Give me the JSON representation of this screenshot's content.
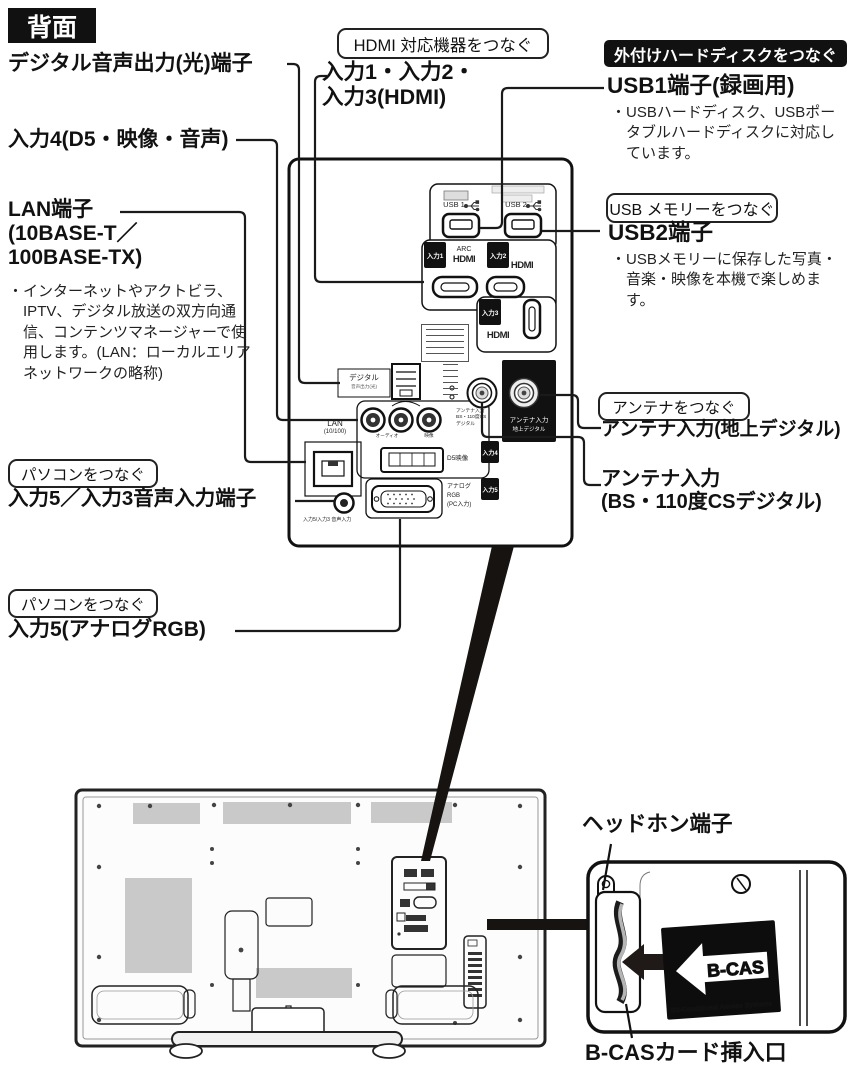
{
  "page": {
    "badge": "背面"
  },
  "left": {
    "optical": "デジタル音声出力(光)端子",
    "input4": "入力4(D5・映像・音声)",
    "lan1": "LAN端子",
    "lan2": "(10BASE-T／",
    "lan3": "100BASE-TX)",
    "bullet": "・",
    "lan_note": "インターネットやアクトビラ、IPTV、デジタル放送の双方向通信、コンテンツマネージャーで使用します。(LAN：ローカルエリアネットワークの略称)",
    "pc_tag": "パソコンをつなぐ",
    "input5_audio": "入力5／入力3音声入力端子",
    "input5_rgb": "入力5(アナログRGB)"
  },
  "top": {
    "hdmi_tag": "HDMI 対応機器をつなぐ",
    "hdmi_line1": "入力1・入力2・",
    "hdmi_line2": "入力3(HDMI)"
  },
  "right": {
    "hdd_tag": "外付けハードディスクをつなぐ",
    "usb1_title": "USB1端子(録画用)",
    "usb1_note": "USBハードディスク、USBポータブルハードディスクに対応しています。",
    "usb_tag": "USB メモリーをつなぐ",
    "usb2_title": "USB2端子",
    "usb2_note": "USBメモリーに保存した写真・音楽・映像を本機で楽しめます。",
    "ant_tag": "アンテナをつなぐ",
    "ant_terrestrial": "アンテナ入力(地上デジタル)",
    "ant_bs1": "アンテナ入力",
    "ant_bs2": "(BS・110度CSデジタル)"
  },
  "bottom": {
    "headphone": "ヘッドホン端子",
    "bcas_slot": "B-CASカード挿入口",
    "bcas_logo": "B-CAS",
    "bcas_sub": "BS-Conditional Access Systems"
  },
  "panel": {
    "usb1": "USB 1",
    "usb2": "USB 2",
    "in1": "入力1",
    "in2": "入力2",
    "in3": "入力3",
    "in4": "入力4",
    "in5": "入力5",
    "arc": "ARC",
    "hdmi": "HDMI",
    "digital": "デジタル",
    "digital_sub": "音声出力(光)",
    "lan": "LAN",
    "lan_sub": "(10/100)",
    "audio_label": "オーディオ",
    "video_label": "映像",
    "d5": "D5映像",
    "rgb1": "アナログ",
    "rgb2": "RGB",
    "rgb3": "(PC入力)",
    "audio_in_sub": "入力5/入力3 音声入力",
    "ant_black1": "アンテナ入力",
    "ant_black2": "地上デジタル",
    "ant_bs_s1": "アンテナ入力",
    "ant_bs_s2": "BS・110度CS",
    "ant_bs_s3": "デジタル"
  },
  "colors": {
    "ink": "#111111",
    "vent_gray": "#c9c9c9"
  }
}
